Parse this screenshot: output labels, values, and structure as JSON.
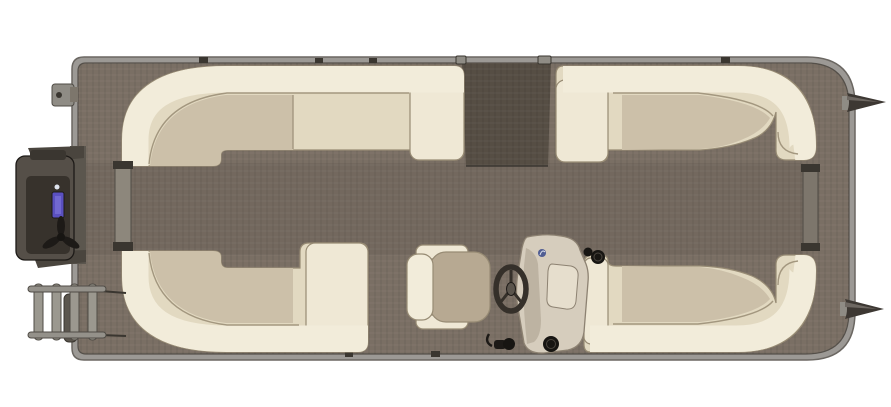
{
  "scene": {
    "type": "pontoon-boat-floor-plan-top-view",
    "background": "#ffffff"
  },
  "colors": {
    "background": "#ffffff",
    "rail": "#9c9995",
    "rail_outline": "#6b6762",
    "deck_line": "#55504a",
    "floor": "#7a6f64",
    "corridor": "#6b6157",
    "gate_walkway": "#564e44",
    "weave_light": "rgba(255,255,255,0.05)",
    "weave_dark": "rgba(0,0,0,0.09)",
    "cushion_seat": "#e2d9c1",
    "cushion_roll": "#f2ecda",
    "cushion_armrest": "#efe8d5",
    "cushion_corner_seat": "#ccc0a9",
    "cushion_outline": "#978b74",
    "seam": "#a3977f",
    "chair_seat": "#b7a992",
    "console_body": "#d6cdbd",
    "console_panel": "#e6decd",
    "console_shadow": "#a99e8d",
    "console_outline": "#8d8272",
    "wheel": "#35302a",
    "wheel_hub": "#5a544c",
    "gauge": "#171512",
    "dark_detail": "#1d1a17",
    "motor_body": "#554f48",
    "motor_inner": "#37322c",
    "motor_bracket": "#4a453e",
    "motor_mount": "#5b564e",
    "motor_sticker": "#5a50c0",
    "motor_sticker_inner": "#7a72d8",
    "ladder": "#94918a",
    "ladder_rung": "#9b988f",
    "ladder_outline": "#4f4b45",
    "gate_post": "#8d877c",
    "gate_post_bow": "#7d766c",
    "hinge": "#8f8c85",
    "cap": "#3a3630",
    "nose_cone": "#3d3833",
    "nose_cone_highlight": "#6e6862",
    "logo_accent": "#3a4a8c",
    "logo_swoosh": "#dfe4ee"
  },
  "components": [
    "deck",
    "woven-vinyl-floor",
    "center-corridor",
    "top-gate-walkway",
    "stern-gate",
    "bow-gate",
    "top-left-lounge",
    "top-right-lounge",
    "bottom-left-lounge",
    "bottom-right-lounge",
    "captains-chair",
    "helm-console",
    "steering-wheel",
    "outboard-motor",
    "swim-ladder",
    "pontoon-nose-cones"
  ]
}
